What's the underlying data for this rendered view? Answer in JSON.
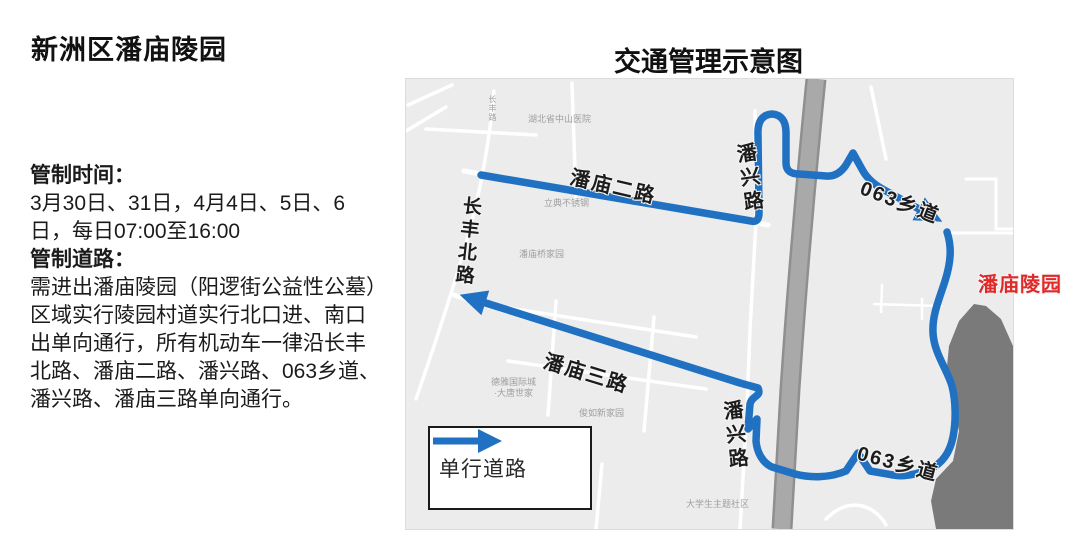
{
  "header": {
    "left_title": "新洲区潘庙陵园",
    "map_title": "交通管理示意图"
  },
  "notice": {
    "time_heading": "管制时间：",
    "time_lines": [
      "3月30日、31日，4月4日、5日、6",
      "日，每日07:00至16:00"
    ],
    "road_heading": "管制道路：",
    "road_lines": [
      "需进出潘庙陵园（阳逻街公益性公墓）",
      "区域实行陵园村道实行北口进、南口",
      "出单向通行，所有机动车一律沿长丰",
      "北路、潘庙二路、潘兴路、063乡道、",
      "潘兴路、潘庙三路单向通行。"
    ]
  },
  "map": {
    "road_labels": {
      "changfeng_north_road": "长丰北路",
      "panmiao_er_road": "潘庙二路",
      "panxing_road_north": "潘兴路",
      "xiangdao_063_north": "063乡道",
      "panmiao_san_road": "潘庙三路",
      "panxing_road_south": "潘兴路",
      "xiangdao_063_south": "063乡道"
    },
    "destination_label": "潘庙陵园",
    "poi_labels": {
      "hospital": "湖北省中山医院",
      "changfeng_road_small": "长丰路",
      "steel_shop": "立典不锈钢",
      "panmiao_bridge_homes": "潘庙桥家园",
      "deya_international": "德雅国际城",
      "datang_shijia": "·大唐世家",
      "residential_mid": "俊如新家园",
      "student_community": "大学生主题社区"
    },
    "legend": {
      "arrow_label": "单行道路"
    },
    "colors": {
      "route_blue": "#2071c2",
      "destination_red": "#e02a2a",
      "water_gray": "#7a7a7a",
      "highway_gray": "#a9a9a9",
      "map_bg": "#ececec"
    }
  }
}
